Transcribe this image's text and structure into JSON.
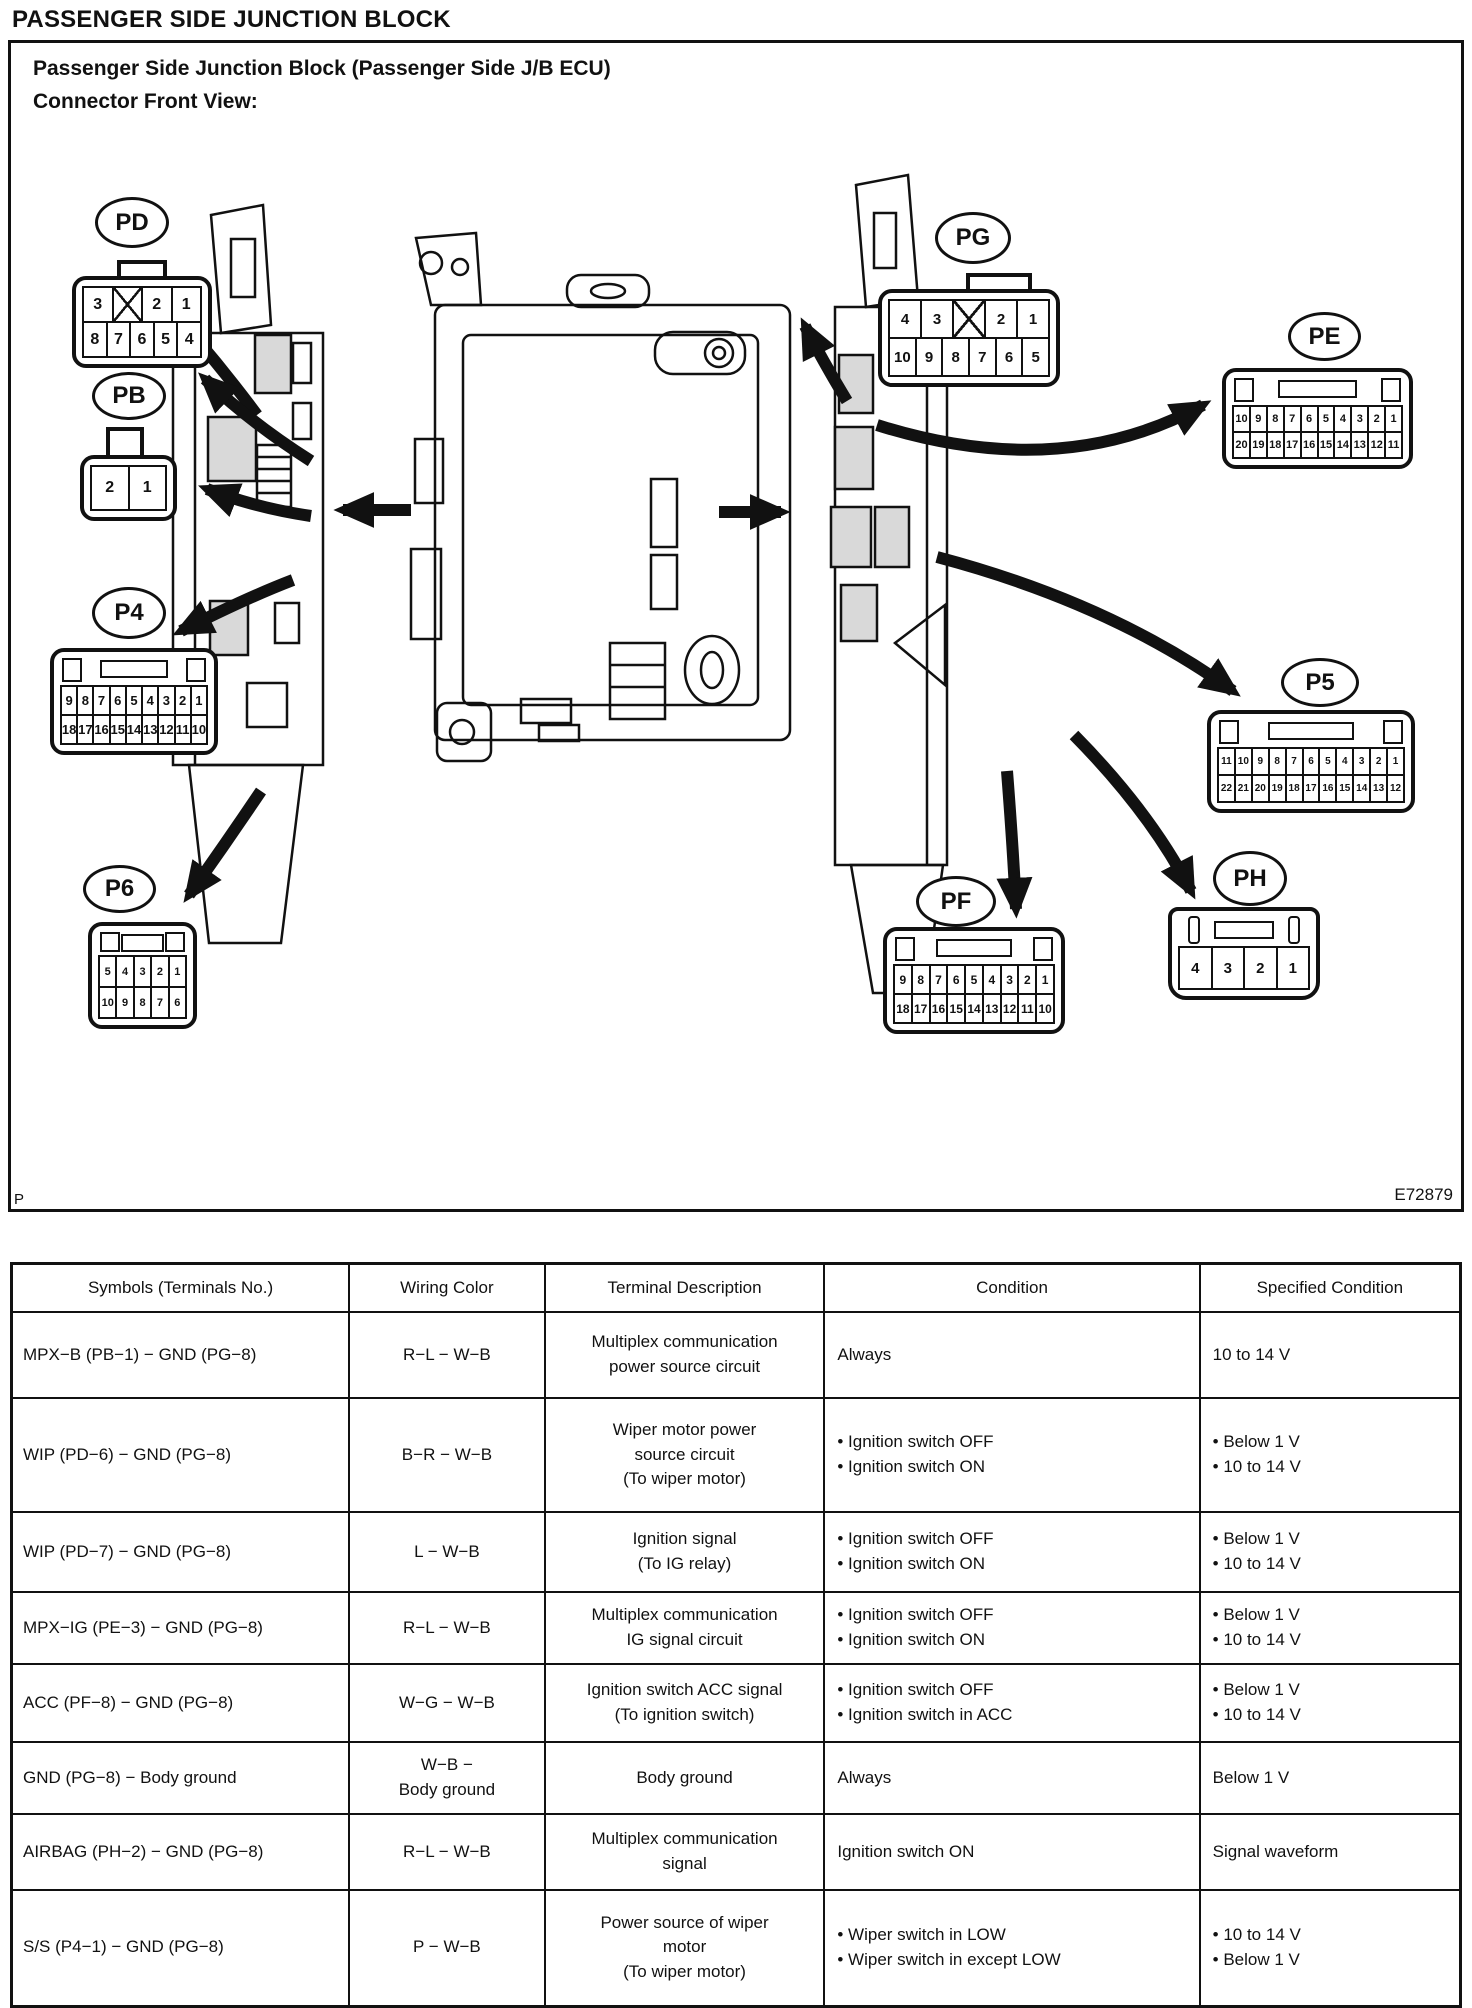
{
  "page": {
    "title": "PASSENGER SIDE JUNCTION BLOCK"
  },
  "figure": {
    "heading": "Passenger Side Junction Block (Passenger Side J/B ECU)\nConnector Front View:",
    "code": "E72879",
    "page_marker": "P"
  },
  "connectors": {
    "pd": {
      "label": "PD",
      "rows": [
        [
          "3",
          "X",
          "2",
          "1"
        ],
        [
          "8",
          "7",
          "6",
          "5",
          "4"
        ]
      ]
    },
    "pb": {
      "label": "PB",
      "rows": [
        [
          "2",
          "1"
        ]
      ]
    },
    "p4": {
      "label": "P4",
      "rows": [
        [
          "9",
          "8",
          "7",
          "6",
          "5",
          "4",
          "3",
          "2",
          "1"
        ],
        [
          "18",
          "17",
          "16",
          "15",
          "14",
          "13",
          "12",
          "11",
          "10"
        ]
      ]
    },
    "p6": {
      "label": "P6",
      "rows": [
        [
          "5",
          "4",
          "3",
          "2",
          "1"
        ],
        [
          "10",
          "9",
          "8",
          "7",
          "6"
        ]
      ]
    },
    "pg": {
      "label": "PG",
      "rows": [
        [
          "4",
          "3",
          "X",
          "2",
          "1"
        ],
        [
          "10",
          "9",
          "8",
          "7",
          "6",
          "5"
        ]
      ]
    },
    "pe": {
      "label": "PE",
      "rows": [
        [
          "10",
          "9",
          "8",
          "7",
          "6",
          "5",
          "4",
          "3",
          "2",
          "1"
        ],
        [
          "20",
          "19",
          "18",
          "17",
          "16",
          "15",
          "14",
          "13",
          "12",
          "11"
        ]
      ]
    },
    "p5": {
      "label": "P5",
      "rows": [
        [
          "11",
          "10",
          "9",
          "8",
          "7",
          "6",
          "5",
          "4",
          "3",
          "2",
          "1"
        ],
        [
          "22",
          "21",
          "20",
          "19",
          "18",
          "17",
          "16",
          "15",
          "14",
          "13",
          "12"
        ]
      ]
    },
    "pf": {
      "label": "PF",
      "rows": [
        [
          "9",
          "8",
          "7",
          "6",
          "5",
          "4",
          "3",
          "2",
          "1"
        ],
        [
          "18",
          "17",
          "16",
          "15",
          "14",
          "13",
          "12",
          "11",
          "10"
        ]
      ]
    },
    "ph": {
      "label": "PH",
      "rows": [
        [
          "4",
          "3",
          "2",
          "1"
        ]
      ]
    }
  },
  "table": {
    "headers": [
      "Symbols (Terminals No.)",
      "Wiring Color",
      "Terminal Description",
      "Condition",
      "Specified Condition"
    ],
    "rows": [
      {
        "symbols": "MPX−B (PB−1) − GND (PG−8)",
        "wiring": "R−L − W−B",
        "description": "Multiplex communication\npower source circuit",
        "condition": "Always",
        "specified": "10 to 14 V"
      },
      {
        "symbols": "WIP (PD−6) − GND (PG−8)",
        "wiring": "B−R − W−B",
        "description": "Wiper motor power\nsource circuit\n(To wiper motor)",
        "condition": "• Ignition switch OFF\n• Ignition switch ON",
        "specified": "• Below 1 V\n• 10 to 14 V"
      },
      {
        "symbols": "WIP (PD−7) − GND (PG−8)",
        "wiring": "L − W−B",
        "description": "Ignition signal\n(To IG relay)",
        "condition": "• Ignition switch OFF\n• Ignition switch ON",
        "specified": "• Below 1 V\n• 10 to 14 V"
      },
      {
        "symbols": "MPX−IG (PE−3) − GND (PG−8)",
        "wiring": "R−L − W−B",
        "description": "Multiplex communication\nIG signal circuit",
        "condition": "• Ignition switch OFF\n• Ignition switch ON",
        "specified": "• Below 1 V\n• 10 to 14 V"
      },
      {
        "symbols": "ACC (PF−8) − GND (PG−8)",
        "wiring": "W−G − W−B",
        "description": "Ignition switch ACC signal\n(To ignition switch)",
        "condition": "• Ignition switch OFF\n• Ignition switch in ACC",
        "specified": "• Below 1 V\n• 10 to 14 V"
      },
      {
        "symbols": "GND (PG−8) − Body ground",
        "wiring": "W−B −\nBody ground",
        "description": "Body ground",
        "condition": "Always",
        "specified": "Below 1 V"
      },
      {
        "symbols": "AIRBAG (PH−2) − GND (PG−8)",
        "wiring": "R−L − W−B",
        "description": "Multiplex communication\nsignal",
        "condition": "Ignition switch ON",
        "specified": "Signal waveform"
      },
      {
        "symbols": "S/S (P4−1) − GND (PG−8)",
        "wiring": "P − W−B",
        "description": "Power source of wiper\nmotor\n(To wiper motor)",
        "condition": "• Wiper switch in LOW\n• Wiper switch in except LOW",
        "specified": "• 10 to 14 V\n• Below 1 V"
      }
    ]
  }
}
